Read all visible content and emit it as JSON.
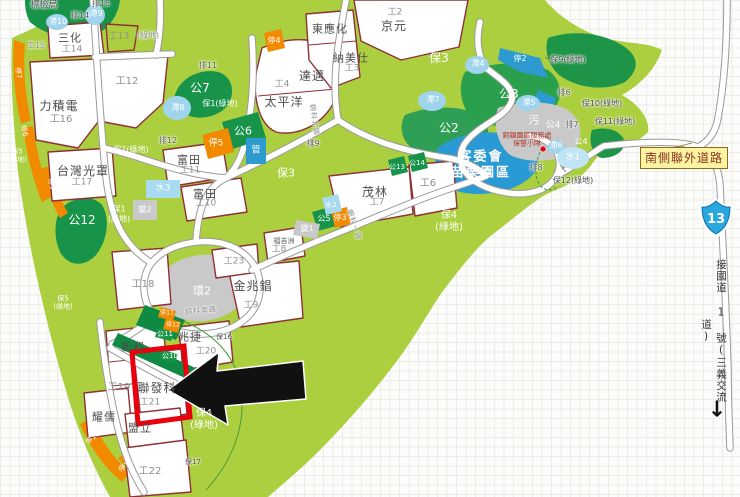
{
  "map": {
    "title_hint": "science-park zoning map",
    "highlighted_plot": "聯發科 工21",
    "labels": [
      {
        "t": "標檢局",
        "x": 44,
        "y": 6,
        "c": "name-sm halo"
      },
      {
        "t": "排15",
        "x": 101,
        "y": 4,
        "c": "drain halo"
      },
      {
        "t": "排14",
        "x": 80,
        "y": 16,
        "c": "drain halo"
      },
      {
        "t": "滯10",
        "x": 58,
        "y": 22,
        "c": "pond"
      },
      {
        "t": "滯9",
        "x": 96,
        "y": 14,
        "c": "pond"
      },
      {
        "t": "三化",
        "x": 70,
        "y": 38,
        "c": "name",
        "s": 11
      },
      {
        "t": "工14",
        "x": 72,
        "y": 50,
        "c": "plot"
      },
      {
        "t": "工13",
        "x": 119,
        "y": 37,
        "c": "plot"
      },
      {
        "t": "(綠地)",
        "x": 148,
        "y": 36,
        "c": "plot halo",
        "s": 8
      },
      {
        "t": "工15",
        "x": 36,
        "y": 46,
        "c": "plot halo",
        "s": 8
      },
      {
        "t": "工12",
        "x": 127,
        "y": 82,
        "c": "plot",
        "s": 10
      },
      {
        "t": "力積電",
        "x": 59,
        "y": 106,
        "c": "name"
      },
      {
        "t": "工16",
        "x": 61,
        "y": 120,
        "c": "plot",
        "s": 10
      },
      {
        "t": "停7",
        "x": 18,
        "y": 73,
        "c": "stop",
        "r": 80,
        "s": 7
      },
      {
        "t": "停6",
        "x": 24,
        "y": 131,
        "c": "stop",
        "r": 75,
        "s": 7
      },
      {
        "t": "停9",
        "x": 51,
        "y": 184,
        "c": "stop",
        "r": 75,
        "s": 7
      },
      {
        "t": "保5\n(綠地)",
        "x": 17,
        "y": 156,
        "c": "park",
        "s": 7
      },
      {
        "t": "保5\n(綠地)",
        "x": 63,
        "y": 303,
        "c": "park",
        "s": 7
      },
      {
        "t": "台灣光罩",
        "x": 83,
        "y": 171,
        "c": "name"
      },
      {
        "t": "工17",
        "x": 82,
        "y": 183,
        "c": "plot"
      },
      {
        "t": "公12",
        "x": 82,
        "y": 220,
        "c": "park",
        "s": 12
      },
      {
        "t": "保1(綠地)",
        "x": 131,
        "y": 150,
        "c": "park",
        "s": 8
      },
      {
        "t": "保1\n(綠地)",
        "x": 119,
        "y": 214,
        "c": "park",
        "s": 8
      },
      {
        "t": "保1(綠地)",
        "x": 220,
        "y": 104,
        "c": "park",
        "s": 8
      },
      {
        "t": "排12",
        "x": 168,
        "y": 141,
        "c": "drain halo"
      },
      {
        "t": "排11",
        "x": 208,
        "y": 66,
        "c": "drain halo"
      },
      {
        "t": "公7",
        "x": 200,
        "y": 88,
        "c": "park",
        "s": 12
      },
      {
        "t": "滯8",
        "x": 178,
        "y": 108,
        "c": "pond"
      },
      {
        "t": "富田",
        "x": 189,
        "y": 160,
        "c": "name",
        "s": 11
      },
      {
        "t": "工11",
        "x": 190,
        "y": 171,
        "c": "plot"
      },
      {
        "t": "富田",
        "x": 205,
        "y": 194,
        "c": "name",
        "s": 11
      },
      {
        "t": "工10",
        "x": 206,
        "y": 204,
        "c": "plot"
      },
      {
        "t": "水3",
        "x": 163,
        "y": 189,
        "c": "pond",
        "s": 9
      },
      {
        "t": "變2",
        "x": 145,
        "y": 210,
        "c": "park",
        "s": 8
      },
      {
        "t": "停5",
        "x": 216,
        "y": 144,
        "c": "stop",
        "s": 9
      },
      {
        "t": "公6",
        "x": 243,
        "y": 131,
        "c": "park",
        "s": 11
      },
      {
        "t": "管",
        "x": 256,
        "y": 151,
        "c": "park",
        "s": 9
      },
      {
        "t": "工18",
        "x": 143,
        "y": 285,
        "c": "plot",
        "s": 10
      },
      {
        "t": "環2",
        "x": 202,
        "y": 291,
        "c": "park",
        "s": 11
      },
      {
        "t": "工23",
        "x": 234,
        "y": 262,
        "c": "plot"
      },
      {
        "t": "銅科北路",
        "x": 314,
        "y": 120,
        "c": "road halo",
        "r": 82
      },
      {
        "t": "銅科南路",
        "x": 201,
        "y": 311,
        "c": "road halo",
        "r": -6
      },
      {
        "t": "銅科一路",
        "x": 354,
        "y": 225,
        "c": "road halo",
        "r": 72
      },
      {
        "t": "停4",
        "x": 274,
        "y": 41,
        "c": "stop"
      },
      {
        "t": "達邁",
        "x": 312,
        "y": 76,
        "c": "name"
      },
      {
        "t": "工4",
        "x": 282,
        "y": 85,
        "c": "plot"
      },
      {
        "t": "太平洋",
        "x": 284,
        "y": 102,
        "c": "name"
      },
      {
        "t": "東應化",
        "x": 330,
        "y": 29,
        "c": "name",
        "s": 11
      },
      {
        "t": "納美仕",
        "x": 351,
        "y": 58,
        "c": "name",
        "s": 11
      },
      {
        "t": "工3",
        "x": 352,
        "y": 69,
        "c": "plot"
      },
      {
        "t": "京元",
        "x": 394,
        "y": 26,
        "c": "name"
      },
      {
        "t": "工2",
        "x": 395,
        "y": 13,
        "c": "plot"
      },
      {
        "t": "保3",
        "x": 439,
        "y": 58,
        "c": "park",
        "s": 12
      },
      {
        "t": "保3",
        "x": 286,
        "y": 173,
        "c": "park",
        "s": 11
      },
      {
        "t": "排9",
        "x": 313,
        "y": 144,
        "c": "drain halo"
      },
      {
        "t": "茂林",
        "x": 375,
        "y": 192,
        "c": "name"
      },
      {
        "t": "工7",
        "x": 377,
        "y": 203,
        "c": "plot"
      },
      {
        "t": "工6",
        "x": 428,
        "y": 184,
        "c": "plot",
        "s": 10
      },
      {
        "t": "公13",
        "x": 397,
        "y": 167,
        "c": "park",
        "s": 7
      },
      {
        "t": "公14",
        "x": 417,
        "y": 163,
        "c": "park",
        "s": 7
      },
      {
        "t": "水2",
        "x": 331,
        "y": 205,
        "c": "pond",
        "s": 7
      },
      {
        "t": "公5",
        "x": 324,
        "y": 219,
        "c": "park",
        "s": 8
      },
      {
        "t": "停3",
        "x": 340,
        "y": 218,
        "c": "stop"
      },
      {
        "t": "變1",
        "x": 307,
        "y": 229,
        "c": "park",
        "s": 8
      },
      {
        "t": "福吉洲",
        "x": 284,
        "y": 241,
        "c": "name-sm halo",
        "s": 7
      },
      {
        "t": "工8",
        "x": 279,
        "y": 250,
        "c": "plot"
      },
      {
        "t": "金兆錩",
        "x": 253,
        "y": 286,
        "c": "name"
      },
      {
        "t": "工9",
        "x": 251,
        "y": 306,
        "c": "plot"
      },
      {
        "t": "保4\n(綠地)",
        "x": 449,
        "y": 222,
        "c": "park",
        "s": 10
      },
      {
        "t": "保4\n(綠地)",
        "x": 204,
        "y": 420,
        "c": "park",
        "s": 10
      },
      {
        "t": "保16",
        "x": 224,
        "y": 337,
        "c": "ann halo",
        "s": 7
      },
      {
        "t": "保17",
        "x": 193,
        "y": 462,
        "c": "ann halo",
        "s": 7
      },
      {
        "t": "兆捷",
        "x": 190,
        "y": 337,
        "c": "name",
        "s": 11
      },
      {
        "t": "工20",
        "x": 206,
        "y": 352,
        "c": "plot"
      },
      {
        "t": "新和",
        "x": 133,
        "y": 347,
        "c": "name",
        "s": 11
      },
      {
        "t": "工19",
        "x": 119,
        "y": 388,
        "c": "plot",
        "s": 10
      },
      {
        "t": "聯發科",
        "x": 157,
        "y": 388,
        "c": "name"
      },
      {
        "t": "工21",
        "x": 150,
        "y": 403,
        "c": "plot"
      },
      {
        "t": "耀儒",
        "x": 104,
        "y": 417,
        "c": "name",
        "s": 11
      },
      {
        "t": "盟立",
        "x": 140,
        "y": 428,
        "c": "name",
        "s": 11
      },
      {
        "t": "工22",
        "x": 150,
        "y": 472,
        "c": "plot",
        "s": 10
      },
      {
        "t": "停13",
        "x": 93,
        "y": 438,
        "c": "stop",
        "r": -40,
        "s": 7
      },
      {
        "t": "停14",
        "x": 126,
        "y": 466,
        "c": "stop",
        "r": -35,
        "s": 7
      },
      {
        "t": "停11",
        "x": 167,
        "y": 313,
        "c": "stop",
        "s": 6
      },
      {
        "t": "停12",
        "x": 173,
        "y": 325,
        "c": "stop",
        "s": 6
      },
      {
        "t": "公11",
        "x": 165,
        "y": 334,
        "c": "park",
        "s": 7
      },
      {
        "t": "公10",
        "x": 170,
        "y": 356,
        "c": "park",
        "s": 7
      },
      {
        "t": "公2",
        "x": 449,
        "y": 128,
        "c": "park",
        "s": 12
      },
      {
        "t": "滯7",
        "x": 433,
        "y": 100,
        "c": "pond"
      },
      {
        "t": "滯4",
        "x": 478,
        "y": 64,
        "c": "pond"
      },
      {
        "t": "公3",
        "x": 509,
        "y": 94,
        "c": "park",
        "s": 12
      },
      {
        "t": "滯5",
        "x": 529,
        "y": 103,
        "c": "pond"
      },
      {
        "t": "停2",
        "x": 520,
        "y": 59,
        "c": "stop"
      },
      {
        "t": "保9(綠地)",
        "x": 568,
        "y": 60,
        "c": "ann halo"
      },
      {
        "t": "排6",
        "x": 564,
        "y": 93,
        "c": "drain halo"
      },
      {
        "t": "保10(綠地)",
        "x": 602,
        "y": 104,
        "c": "ann halo"
      },
      {
        "t": "保11(綠地)",
        "x": 615,
        "y": 122,
        "c": "ann halo"
      },
      {
        "t": "排7",
        "x": 572,
        "y": 125,
        "c": "drain halo"
      },
      {
        "t": "污",
        "x": 534,
        "y": 120,
        "c": "park",
        "s": 11
      },
      {
        "t": "公4",
        "x": 553,
        "y": 126,
        "c": "park",
        "s": 9
      },
      {
        "t": "公4",
        "x": 581,
        "y": 142,
        "c": "park",
        "s": 8
      },
      {
        "t": "客委會\n苗栗園區",
        "x": 481,
        "y": 165,
        "c": "lake-name"
      },
      {
        "t": "銅鑼園區服務處\n保警小隊",
        "x": 527,
        "y": 140,
        "c": "note"
      },
      {
        "t": "滯6",
        "x": 556,
        "y": 146,
        "c": "pond"
      },
      {
        "t": "水1",
        "x": 573,
        "y": 158,
        "c": "pond",
        "s": 9
      },
      {
        "t": "排8",
        "x": 536,
        "y": 168,
        "c": "drain halo"
      },
      {
        "t": "保12(綠地)",
        "x": 573,
        "y": 181,
        "c": "ann halo"
      }
    ]
  },
  "right": {
    "south_road": "南側聯外道路",
    "shield": "13",
    "note_vertical": "接國道 1 號(三義交流道)",
    "down_arrow": "↓"
  },
  "palette": {
    "highlight_red": "#e8000d",
    "base_green": "#abcf3e",
    "park_green": "#17934a",
    "lake_blue": "#2a9ad4",
    "pond_blue": "#9fd4ec",
    "parking_orange": "#f28a00",
    "plot_border": "#8e3036",
    "road_note_bg": "#faf3a0"
  }
}
